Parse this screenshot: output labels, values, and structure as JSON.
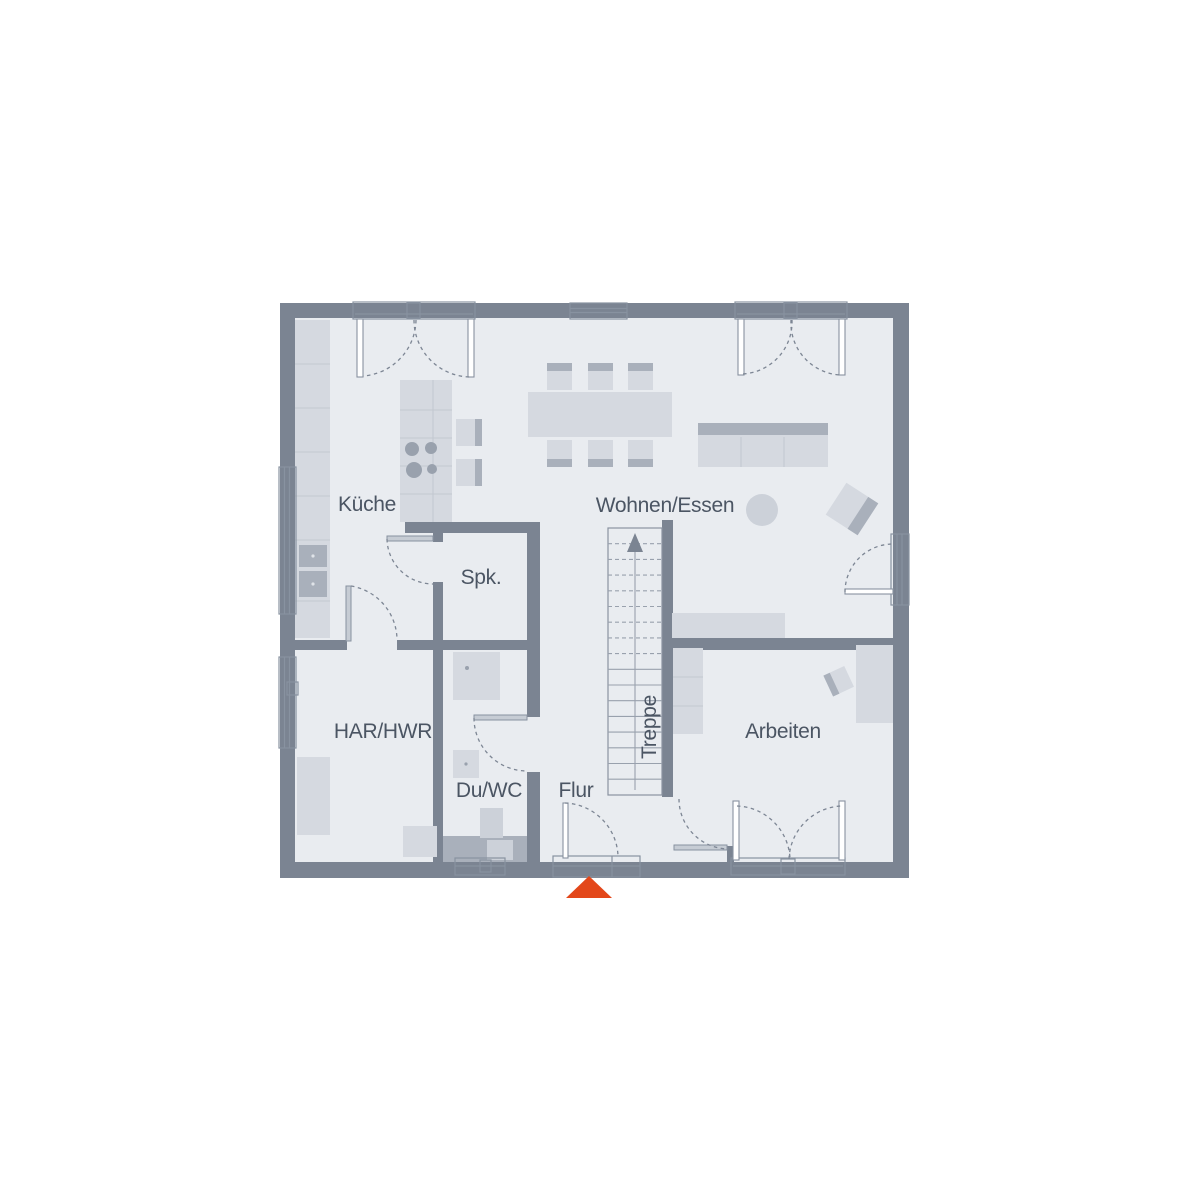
{
  "floorplan": {
    "colors": {
      "wall": "#7B8492",
      "floor": "#E9ECF0",
      "furniture": "#D5D9E0",
      "furniture_dark": "#A9B0BB",
      "line": "#8892A0",
      "text": "#4B5563",
      "arrow": "#E3471A"
    },
    "rooms": [
      {
        "id": "kueche",
        "label": "Küche"
      },
      {
        "id": "wohnen-essen",
        "label": "Wohnen/Essen"
      },
      {
        "id": "spk",
        "label": "Spk."
      },
      {
        "id": "har-hwr",
        "label": "HAR/HWR"
      },
      {
        "id": "du-wc",
        "label": "Du/WC"
      },
      {
        "id": "flur",
        "label": "Flur"
      },
      {
        "id": "arbeiten",
        "label": "Arbeiten"
      },
      {
        "id": "treppe",
        "label": "Treppe"
      }
    ],
    "stairs": {
      "direction": "up"
    },
    "entrance": {
      "marker": "arrow-up"
    }
  }
}
